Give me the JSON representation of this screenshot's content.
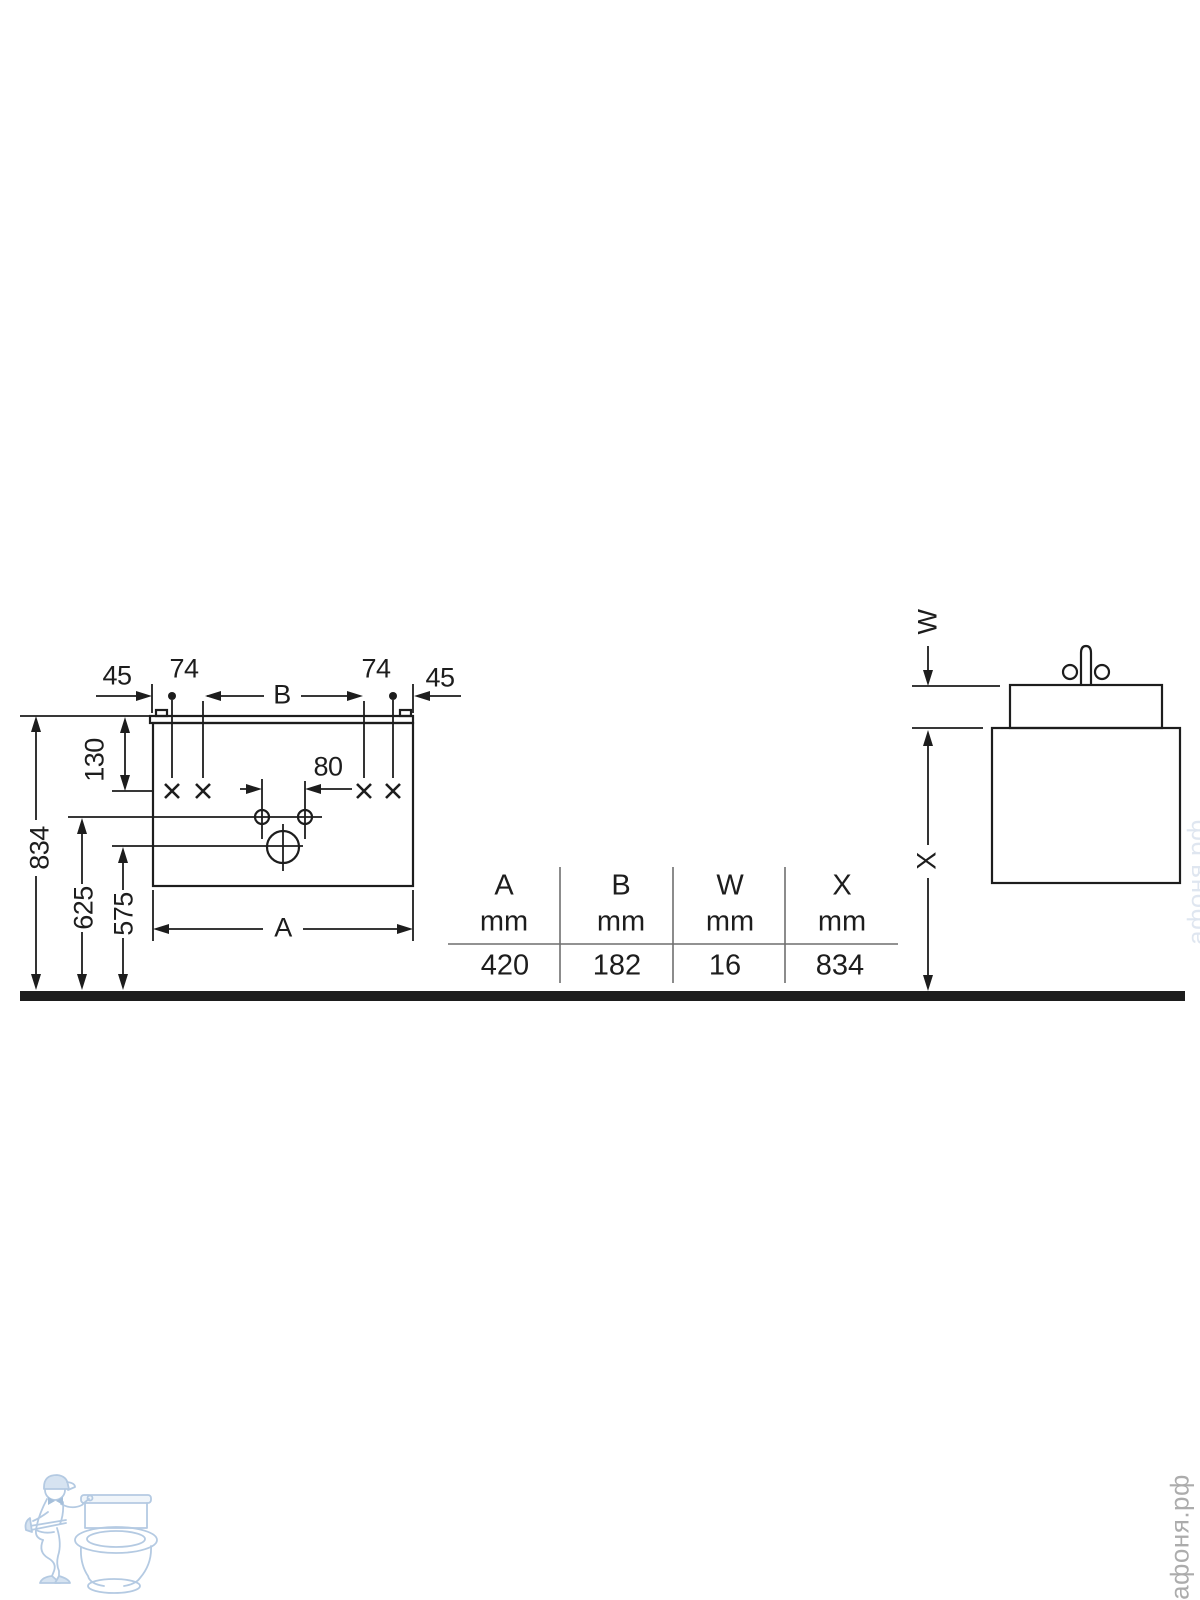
{
  "front_view": {
    "dims": {
      "left_offset": "45",
      "screw_inset_left": "74",
      "hole_span": "B",
      "screw_inset_right": "74",
      "right_offset": "45",
      "screw_drop_from_top": "130",
      "total_height": "834",
      "faucet_hole_height": "625",
      "drain_height": "575",
      "faucet_hole_spacing": "80",
      "width": "A"
    }
  },
  "side_view": {
    "dims": {
      "top_gap": "W",
      "underside_height": "X"
    }
  },
  "table": {
    "columns": [
      {
        "letter": "A",
        "unit": "mm",
        "value": "420"
      },
      {
        "letter": "B",
        "unit": "mm",
        "value": "182"
      },
      {
        "letter": "W",
        "unit": "mm",
        "value": "16"
      },
      {
        "letter": "X",
        "unit": "mm",
        "value": "834"
      }
    ]
  },
  "watermarks": {
    "brand": "афоня.рф"
  },
  "colors": {
    "line": "#1d1d1d",
    "table_rule": "#6f6f6f",
    "watermark_blue": "#a2bddc",
    "watermark_gray": "#acacac"
  }
}
